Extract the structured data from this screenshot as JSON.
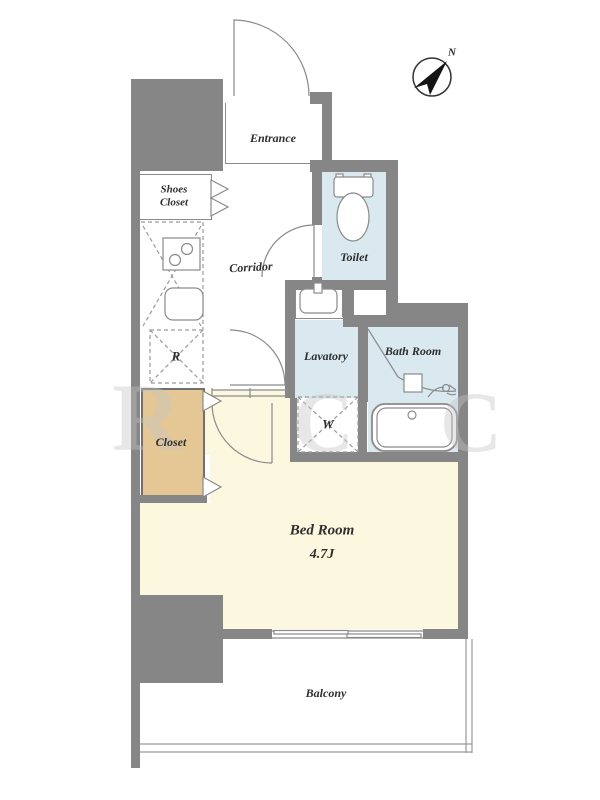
{
  "plan": {
    "rooms": {
      "entrance": {
        "label": "Entrance"
      },
      "shoes_closet": {
        "label": "Shoes\nCloset"
      },
      "corridor": {
        "label": "Corridor"
      },
      "toilet": {
        "label": "Toilet"
      },
      "lavatory": {
        "label": "Lavatory"
      },
      "bath_room": {
        "label": "Bath Room"
      },
      "closet": {
        "label": "Closet"
      },
      "bed_room": {
        "label": "Bed Room",
        "size": "4.7J"
      },
      "balcony": {
        "label": "Balcony"
      }
    },
    "markers": {
      "refrigerator": "R",
      "washer": "W"
    },
    "compass": {
      "north": "N"
    },
    "watermark": {
      "l1": "R",
      "l2": "C",
      "l3": "C"
    },
    "colors": {
      "wall": "#868686",
      "wet_area": "#d9e9ef",
      "bedroom": "#fcf8e0",
      "closet": "#e5c795",
      "line": "#8a8a8a"
    }
  }
}
